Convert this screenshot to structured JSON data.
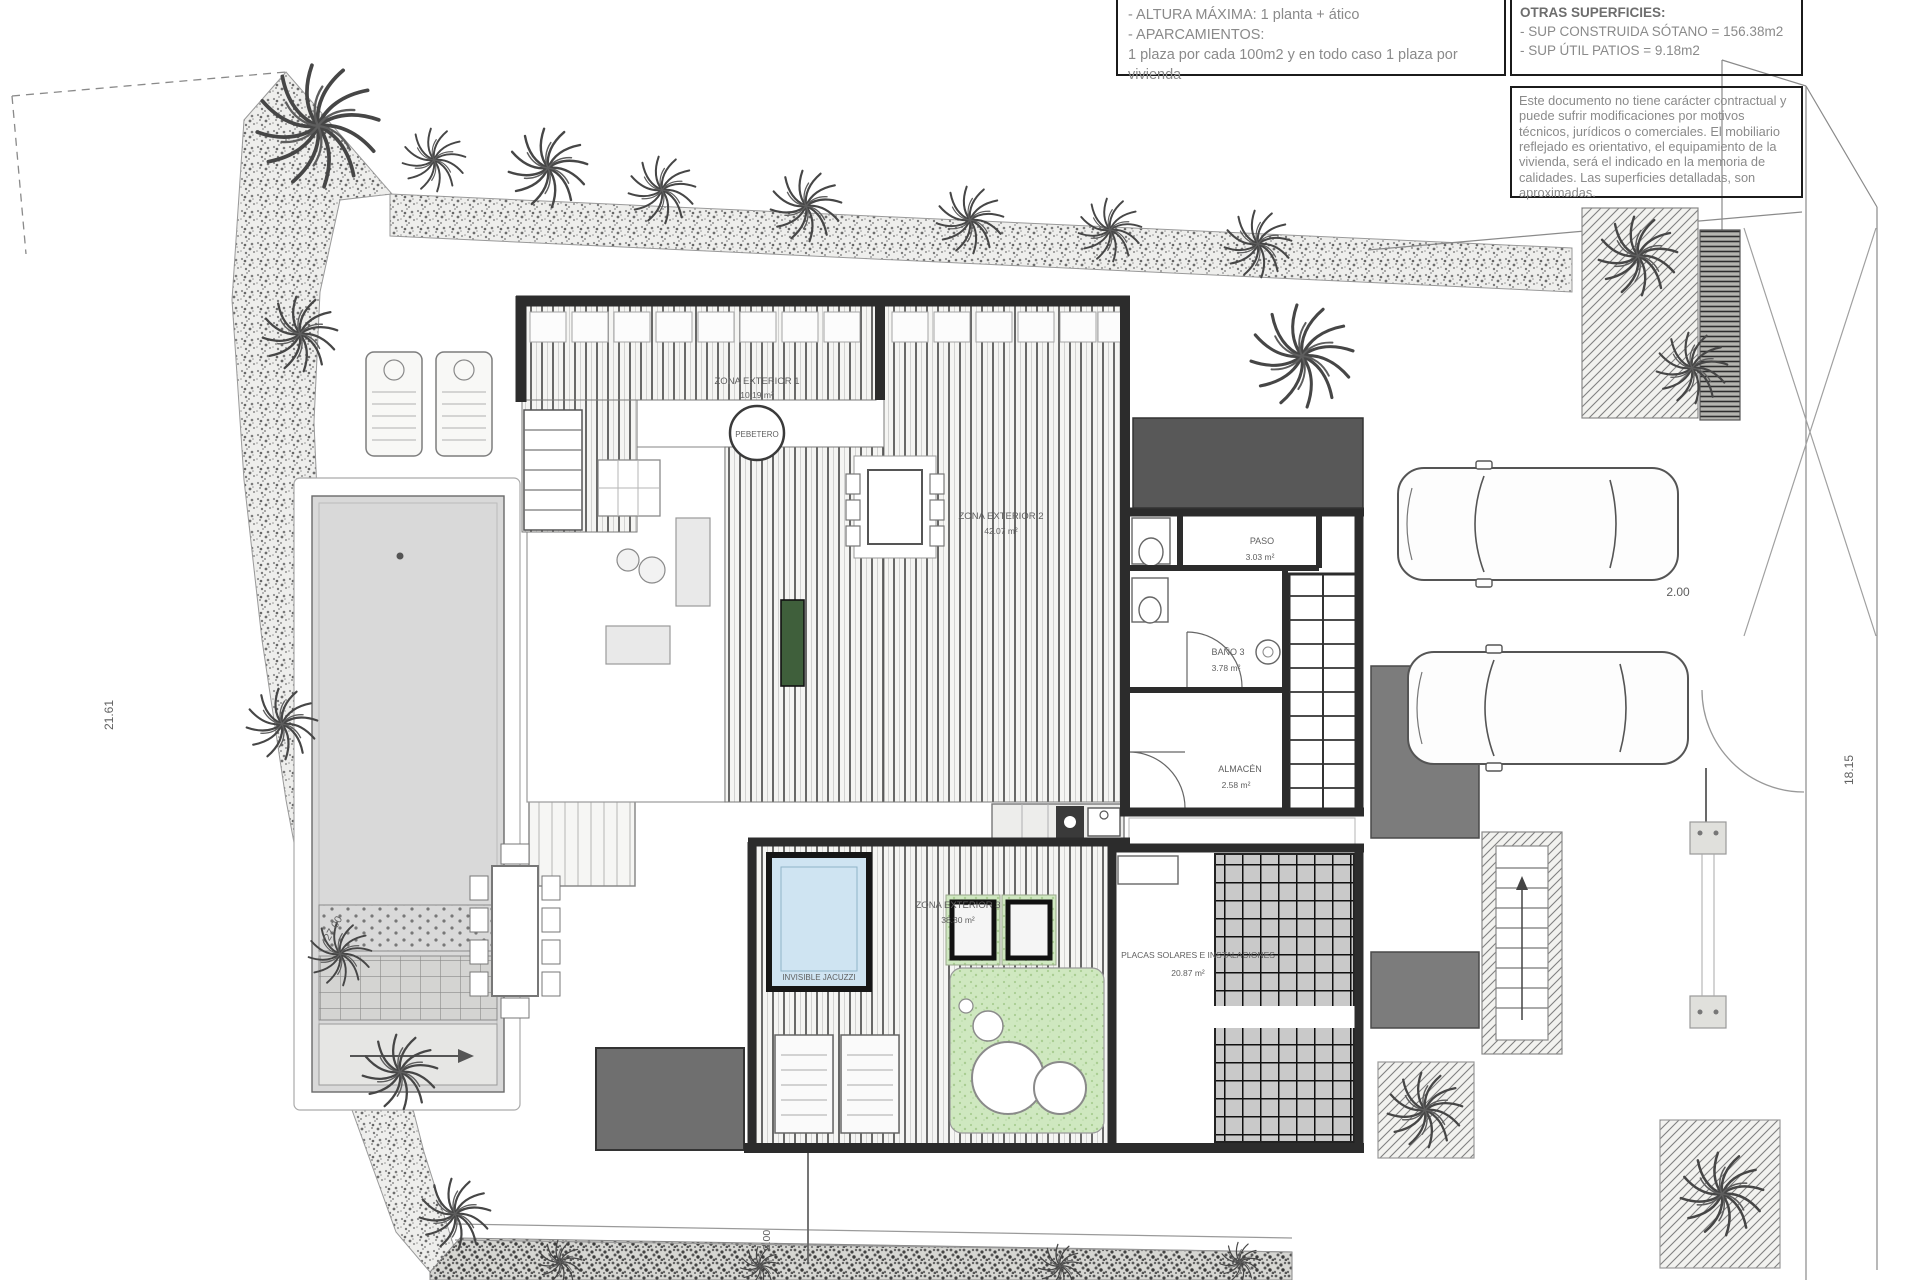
{
  "title_blocks": {
    "building_rules": {
      "lines": [
        "- ALTURA MÁXIMA: 1 planta + ático",
        "- APARCAMIENTOS:",
        "1 plaza por cada 100m2 y en todo caso 1 plaza por vivienda"
      ]
    },
    "other_surfaces": {
      "title": "OTRAS SUPERFICIES:",
      "lines": [
        "- SUP CONSTRUIDA SÓTANO =  156.38m2",
        "- SUP ÚTIL PATIOS =  9.18m2"
      ]
    },
    "disclaimer": "Este documento no tiene carácter contractual y puede sufrir modificaciones por motivos técnicos, jurídicos o comerciales. El mobiliario reflejado es orientativo, el equipamiento de la vivienda, será el indicado en la memoria de calidades. Las superficies detalladas, son aproximadas."
  },
  "rooms": {
    "zona_exterior_1": {
      "name": "ZONA EXTERIOR 1",
      "area": "10.19 m²"
    },
    "zona_exterior_2": {
      "name": "ZONA EXTERIOR 2",
      "area": "42.07 m²"
    },
    "zona_exterior_3": {
      "name": "ZONA EXTERIOR 3",
      "area": "38.30 m²"
    },
    "paso": {
      "name": "PASO",
      "area": "3.03 m²"
    },
    "bano3": {
      "name": "BAÑO 3",
      "area": "3.78 m²"
    },
    "almacen": {
      "name": "ALMACÉN",
      "area": "2.58 m²"
    },
    "placas": {
      "name": "PLACAS SOLARES E INSTALACIONES",
      "area": "20.87 m²"
    },
    "pebetero": {
      "name": "PEBETERO"
    },
    "jacuzzi": {
      "name": "INVISIBLE JACUZZI"
    }
  },
  "dimensions": {
    "left_boundary": "21.61",
    "right_boundary": "18.15",
    "garage_width": "2.00",
    "bottom_path": "2.00",
    "pool_length": "27.00"
  },
  "colors": {
    "wall": "#2c2c2c",
    "deck_line": "#3a3a3a",
    "pergola": "#585858",
    "pool_water": "#d9d9d9",
    "jacuzzi_water": "#cfe4f2",
    "lawn": "#cfe8c0",
    "planter_green": "#3f5f3b",
    "garage_block": "#6f6f6f",
    "label_text": "#5f5f5f",
    "annotation_text": "#8a8a8a"
  }
}
